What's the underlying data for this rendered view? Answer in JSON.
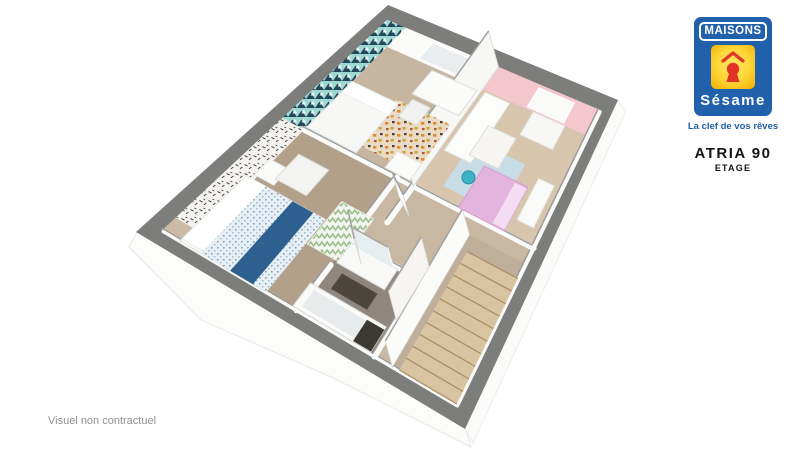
{
  "branding": {
    "brand_top": "MAISONS",
    "brand_bottom": "Sésame",
    "tagline": "La clef de vos rêves",
    "model_name": "ATRIA 90",
    "floor_label": "ETAGE",
    "brand_blue": "#2160ab",
    "brand_yellow": "#ffd83a",
    "brand_red": "#e23328"
  },
  "disclaimer": "Visuel non contractuel",
  "plan": {
    "corners": {
      "T": [
        388,
        5
      ],
      "R": [
        618,
        100
      ],
      "B": [
        465,
        429
      ],
      "L": [
        136,
        232
      ]
    },
    "colors": {
      "outer_wall_gray": "#7d7d7b",
      "base_floor": "#cbbaa7",
      "wood_floor": "#d7c5ae",
      "carpet_floor": "#b3a08b",
      "bath_floor": "#8f867f",
      "stair_wood": "#d9c4a2",
      "accent_teal": "#9ed8d2",
      "accent_teal_dark": "#24465a",
      "accent_pink": "#f4c7cf",
      "bed_navy": "#2e608f",
      "kid_bed_pink": "#e2b4de"
    },
    "scene": [
      {
        "name": "facade-lower-left",
        "kind": "poly",
        "pts": [
          [
            137,
            232
          ],
          [
            465,
            428
          ],
          [
            471,
            447
          ],
          [
            329,
            376
          ],
          [
            201,
            320
          ],
          [
            129,
            247
          ]
        ],
        "fill": "#fcfcfb",
        "stroke": "#e8e8e6",
        "sw": 1
      },
      {
        "name": "facade-lower-right",
        "kind": "poly",
        "pts": [
          [
            617,
            100
          ],
          [
            465,
            428
          ],
          [
            473,
            443
          ],
          [
            626,
            111
          ]
        ],
        "fill": "#fbfbfa",
        "stroke": "#ececea",
        "sw": 1
      },
      {
        "name": "exterior-wall-band",
        "kind": "poly",
        "pts": [
          [
            388,
            5
          ],
          [
            618,
            100
          ],
          [
            465,
            429
          ],
          [
            136,
            232
          ]
        ],
        "fill": "#7d7d7b"
      },
      {
        "name": "floor-base",
        "kind": "rect",
        "rect": [
          0.045,
          0.045,
          0.955,
          0.955
        ],
        "fill": "#cbbaa7"
      },
      {
        "name": "bedroom3-floor",
        "kind": "rect",
        "rect": [
          0.125,
          0.125,
          0.52,
          0.47
        ],
        "fill": "#c6b5a1"
      },
      {
        "name": "kids-room-floor",
        "kind": "rect",
        "rect": [
          0.52,
          0.125,
          0.955,
          0.47
        ],
        "fill": "#d7c5ae"
      },
      {
        "name": "master-bedroom-floor",
        "kind": "rect",
        "rect": [
          0.125,
          0.46,
          0.46,
          0.955
        ],
        "fill": "#b3a08b"
      },
      {
        "name": "landing-floor",
        "kind": "rect",
        "rect": [
          0.46,
          0.47,
          0.955,
          0.955
        ],
        "fill": "#c8b7a3"
      },
      {
        "name": "bathroom-floor",
        "kind": "rect",
        "rect": [
          0.46,
          0.7,
          0.7,
          0.955
        ],
        "fill": "#8f867f"
      },
      {
        "name": "stairwell-floor",
        "kind": "rect",
        "rect": [
          0.755,
          0.52,
          0.955,
          0.955
        ],
        "fill": "#bfae9a"
      },
      {
        "name": "teal-accent-wall",
        "kind": "rect",
        "rect": [
          0.045,
          0.045,
          0.125,
          0.47
        ],
        "fill": "url(#pat-teal)"
      },
      {
        "name": "master-wallpaper-wall",
        "kind": "rect",
        "rect": [
          0.045,
          0.47,
          0.125,
          0.9
        ],
        "fill": "url(#pat-bw)"
      },
      {
        "name": "bedroom3-back-wall",
        "kind": "rect",
        "rect": [
          0.125,
          0.045,
          0.52,
          0.125
        ],
        "fill": "#fbfbf9"
      },
      {
        "name": "bedroom3-window",
        "kind": "rect",
        "rect": [
          0.25,
          0.055,
          0.42,
          0.118
        ],
        "fill": "#e9edee",
        "stroke": "#ffffff",
        "sw": 1.5
      },
      {
        "name": "kids-room-pink-wall",
        "kind": "rect",
        "rect": [
          0.52,
          0.045,
          0.955,
          0.125
        ],
        "fill": "#f4c7cf"
      },
      {
        "name": "kids-room-wall-shelf",
        "kind": "rect",
        "rect": [
          0.7,
          0.055,
          0.85,
          0.118
        ],
        "fill": "#fafaf8",
        "stroke": "#ffffff",
        "sw": 1.2
      },
      {
        "name": "inner-wall-edge",
        "kind": "lowwall",
        "w": 4,
        "pts": [
          [
            0.955,
            0.05
          ],
          [
            0.955,
            0.955
          ],
          [
            0.05,
            0.955
          ]
        ]
      },
      {
        "name": "wall-bedrooms-separator",
        "kind": "lowwall",
        "pts": [
          [
            0.125,
            0.47
          ],
          [
            0.955,
            0.47
          ]
        ]
      },
      {
        "name": "wall-master-hall-upper",
        "kind": "lowwall",
        "pts": [
          [
            0.46,
            0.47
          ],
          [
            0.46,
            0.67
          ]
        ]
      },
      {
        "name": "wall-master-hall-lower",
        "kind": "lowwall",
        "pts": [
          [
            0.46,
            0.79
          ],
          [
            0.46,
            0.955
          ]
        ]
      },
      {
        "name": "wall-bathroom-top",
        "kind": "lowwall",
        "pts": [
          [
            0.46,
            0.7
          ],
          [
            0.7,
            0.7
          ]
        ]
      },
      {
        "name": "wall-bathroom-right",
        "kind": "lowwall",
        "pts": [
          [
            0.7,
            0.7
          ],
          [
            0.7,
            0.955
          ]
        ]
      },
      {
        "name": "wall-hall-corridor",
        "kind": "lowwall",
        "pts": [
          [
            0.52,
            0.47
          ],
          [
            0.52,
            0.6
          ]
        ]
      },
      {
        "name": "wall-bedroom3-kids-tall",
        "kind": "standing",
        "base": [
          [
            0.52,
            0.045
          ],
          [
            0.52,
            0.47
          ]
        ],
        "e": [
          -10,
          -36
        ],
        "fill": "#f7f7f5"
      },
      {
        "name": "wall-stairwell-tall",
        "kind": "standing",
        "base": [
          [
            0.755,
            0.52
          ],
          [
            0.755,
            0.955
          ]
        ],
        "e": [
          -7,
          -26
        ],
        "fill": "#fbfbfa"
      },
      {
        "name": "bedroom3-rug",
        "kind": "rect",
        "rect": [
          0.29,
          0.26,
          0.5,
          0.435
        ],
        "fill": "url(#pat-rug)"
      },
      {
        "name": "master-zigzag-rug",
        "kind": "rect",
        "rect": [
          0.37,
          0.61,
          0.48,
          0.77
        ],
        "fill": "url(#pat-zig)",
        "stroke": "#e7ecdf",
        "sw": 1
      },
      {
        "name": "kids-room-rug",
        "kind": "rect",
        "rect": [
          0.6,
          0.27,
          0.8,
          0.43
        ],
        "fill": "#c7dce5"
      },
      {
        "name": "bedroom3-bed",
        "kind": "rect",
        "rect": [
          0.125,
          0.27,
          0.305,
          0.46
        ],
        "fill": "#f7f7f5",
        "stroke": "#e3e3e1",
        "sw": 1
      },
      {
        "name": "bedroom3-bed-pillow",
        "kind": "rect",
        "rect": [
          0.125,
          0.27,
          0.305,
          0.315
        ],
        "fill": "#ffffff",
        "stroke": "#ededeb",
        "sw": 1
      },
      {
        "name": "bedroom3-desk",
        "kind": "rect",
        "rect": [
          0.32,
          0.135,
          0.505,
          0.225
        ],
        "fill": "#fbfbf9",
        "stroke": "#e0e0de",
        "sw": 1
      },
      {
        "name": "bedroom3-chair",
        "kind": "rect",
        "rect": [
          0.335,
          0.24,
          0.405,
          0.305
        ],
        "fill": "#f1f1ef",
        "stroke": "#dcdcda",
        "sw": 1
      },
      {
        "name": "bedroom3-bench",
        "kind": "rect",
        "rect": [
          0.41,
          0.4,
          0.5,
          0.46
        ],
        "fill": "#fafaf8",
        "stroke": "#e4e4e2",
        "sw": 1
      },
      {
        "name": "kids-wardrobe",
        "kind": "rect",
        "rect": [
          0.535,
          0.13,
          0.635,
          0.335
        ],
        "fill": "#fcfcfb",
        "stroke": "#e6e6e4",
        "sw": 1
      },
      {
        "name": "kids-dresser",
        "kind": "rect",
        "rect": [
          0.73,
          0.125,
          0.86,
          0.2
        ],
        "fill": "#f7f7f5",
        "stroke": "#e3e3e1",
        "sw": 1
      },
      {
        "name": "kids-dollhouse",
        "kind": "rect",
        "rect": [
          0.615,
          0.215,
          0.725,
          0.315
        ],
        "fill": "#f6f5f2",
        "stroke": "#dddddb",
        "sw": 1
      },
      {
        "name": "kids-bed",
        "kind": "rect",
        "rect": [
          0.68,
          0.325,
          0.845,
          0.465
        ],
        "fill": "#e2b4de",
        "stroke": "#d49fd0",
        "sw": 1
      },
      {
        "name": "kids-bed-pillow",
        "kind": "rect",
        "rect": [
          0.8,
          0.33,
          0.845,
          0.46
        ],
        "fill": "#f4dcf2"
      },
      {
        "name": "kids-shelf-unit",
        "kind": "rect",
        "rect": [
          0.865,
          0.29,
          0.925,
          0.42
        ],
        "fill": "#fafaf8",
        "stroke": "#e6e6e4",
        "sw": 1
      },
      {
        "name": "kids-owl-toy",
        "kind": "circle",
        "at": [
          0.655,
          0.375
        ],
        "r": 6.5,
        "fill": "#3db4c6",
        "stroke": "#2a8fa3"
      },
      {
        "name": "master-bed",
        "kind": "rect",
        "rect": [
          0.1,
          0.68,
          0.365,
          0.955
        ],
        "fill": "#f6f6f4",
        "stroke": "#e2e2e0",
        "sw": 1
      },
      {
        "name": "master-bed-pillows",
        "kind": "rect",
        "rect": [
          0.1,
          0.68,
          0.175,
          0.945
        ],
        "fill": "#ffffff",
        "stroke": "#ececea",
        "sw": 1
      },
      {
        "name": "master-bed-duvet",
        "kind": "rect",
        "rect": [
          0.165,
          0.68,
          0.365,
          0.955
        ],
        "fill": "url(#pat-dots)"
      },
      {
        "name": "master-bed-runner",
        "kind": "rect",
        "rect": [
          0.255,
          0.68,
          0.325,
          0.955
        ],
        "fill": "#2e608f"
      },
      {
        "name": "master-nightstand",
        "kind": "rect",
        "rect": [
          0.115,
          0.6,
          0.18,
          0.665
        ],
        "fill": "#fafaf8",
        "stroke": "#e4e4e2",
        "sw": 1
      },
      {
        "name": "master-armchair",
        "kind": "rect",
        "rect": [
          0.17,
          0.545,
          0.275,
          0.645
        ],
        "fill": "#f3f3f1",
        "stroke": "#dedddb",
        "sw": 1
      },
      {
        "name": "bathroom-vanity",
        "kind": "rect",
        "rect": [
          0.47,
          0.705,
          0.625,
          0.775
        ],
        "fill": "#f8f8f6",
        "stroke": "#dfdfdd",
        "sw": 1
      },
      {
        "name": "bathroom-mirror",
        "kind": "standing",
        "base": [
          [
            0.485,
            0.71
          ],
          [
            0.615,
            0.71
          ]
        ],
        "e": [
          -6,
          -22
        ],
        "fill": "#e7eef0",
        "stroke": "#fdfdfd"
      },
      {
        "name": "bathroom-mat",
        "kind": "rect",
        "rect": [
          0.5,
          0.795,
          0.615,
          0.85
        ],
        "fill": "#4c463f"
      },
      {
        "name": "bathtub",
        "kind": "rect",
        "rect": [
          0.445,
          0.865,
          0.685,
          0.95
        ],
        "fill": "#fafaf9",
        "stroke": "#d9d9d7",
        "sw": 1
      },
      {
        "name": "bathtub-inner",
        "kind": "rect",
        "rect": [
          0.465,
          0.878,
          0.665,
          0.938
        ],
        "fill": "#e7ebeb"
      },
      {
        "name": "bathtub-dark-mat",
        "kind": "rect",
        "rect": [
          0.63,
          0.875,
          0.685,
          0.948
        ],
        "fill": "#3c3833"
      },
      {
        "name": "door-master",
        "kind": "standing",
        "base": [
          [
            0.465,
            0.68
          ],
          [
            0.53,
            0.745
          ]
        ],
        "e": [
          -7,
          -26
        ],
        "fill": "#fcfcfb"
      },
      {
        "name": "door-hall-open",
        "kind": "standing",
        "base": [
          [
            0.7,
            0.655
          ],
          [
            0.7,
            0.835
          ]
        ],
        "e": [
          -8,
          -30
        ],
        "fill": "#f7f5f1",
        "stroke": "#d8d5d0"
      },
      {
        "name": "door-bedroom3",
        "kind": "standing",
        "base": [
          [
            0.5,
            0.515
          ],
          [
            0.565,
            0.555
          ]
        ],
        "e": [
          -6,
          -22
        ],
        "fill": "#fcfcfb"
      },
      {
        "name": "staircase",
        "kind": "stairs",
        "rect": [
          0.775,
          0.565,
          0.952,
          0.952
        ],
        "treads": 10,
        "fill": "#d9c4a2",
        "line": "#ab9068"
      }
    ]
  }
}
